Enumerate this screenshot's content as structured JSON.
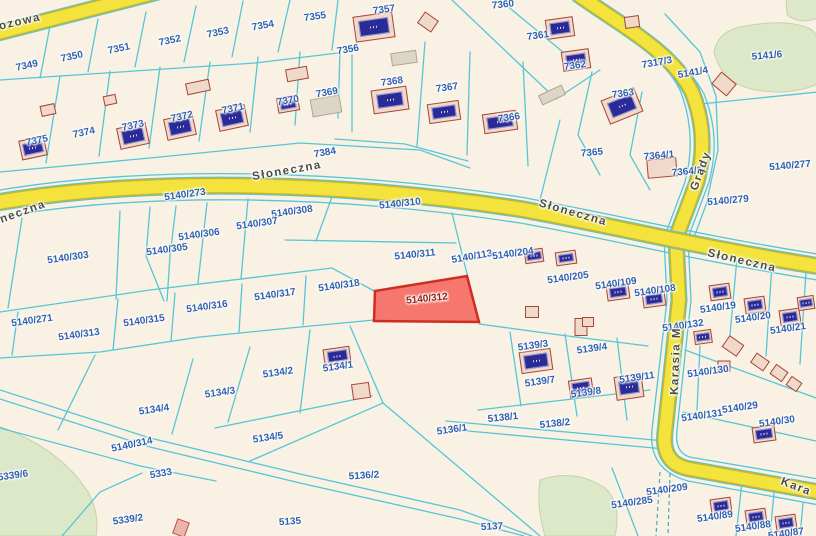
{
  "map": {
    "type": "cadastral-parcel-map",
    "highlighted_parcel": "5140/312",
    "colors": {
      "bg": "#f9f2e4",
      "boundary": "#55c6d6",
      "road": "#f3e33c",
      "roadedge": "#c9b62c",
      "casing": "#58c3d4",
      "green": "#dce8c8",
      "greenedge": "#c2d4a8",
      "bfill": "#f0d9c8",
      "bstroke": "#a6453a",
      "grayfill": "#dcd6c4",
      "pinkfill": "#e9b6ae",
      "chip": "#2b2b98",
      "label": "#2e5fae",
      "street": "#4c4c42",
      "hfill": "#f4695f",
      "hstroke": "#cf2d22",
      "hlabel": "#93221a"
    },
    "street_labels": [
      {
        "text": "ozowa",
        "x": 20,
        "y": 22,
        "r": -13
      },
      {
        "text": "neczna",
        "x": 23,
        "y": 212,
        "r": -20
      },
      {
        "text": "Słoneczna",
        "x": 287,
        "y": 171,
        "r": -10
      },
      {
        "text": "Słoneczna",
        "x": 573,
        "y": 213,
        "r": 16
      },
      {
        "text": "Słoneczna",
        "x": 742,
        "y": 261,
        "r": 13
      },
      {
        "text": "Grądy",
        "x": 701,
        "y": 171,
        "r": -70
      },
      {
        "text": "Karasia M",
        "x": 676,
        "y": 361,
        "r": -88
      },
      {
        "text": "Kara",
        "x": 796,
        "y": 487,
        "r": 21
      }
    ],
    "parcel_labels": [
      {
        "text": "7349",
        "x": 27,
        "y": 66,
        "r": -12
      },
      {
        "text": "7350",
        "x": 72,
        "y": 57,
        "r": -12
      },
      {
        "text": "7351",
        "x": 119,
        "y": 49,
        "r": -12
      },
      {
        "text": "7352",
        "x": 170,
        "y": 41,
        "r": -12
      },
      {
        "text": "7353",
        "x": 218,
        "y": 33,
        "r": -12
      },
      {
        "text": "7354",
        "x": 263,
        "y": 26,
        "r": -10
      },
      {
        "text": "7355",
        "x": 315,
        "y": 17,
        "r": -8
      },
      {
        "text": "7357",
        "x": 384,
        "y": 10,
        "r": -8
      },
      {
        "text": "7360",
        "x": 503,
        "y": 5,
        "r": -6
      },
      {
        "text": "7375",
        "x": 37,
        "y": 141,
        "r": -12
      },
      {
        "text": "7374",
        "x": 84,
        "y": 133,
        "r": -12
      },
      {
        "text": "7373",
        "x": 133,
        "y": 126,
        "r": -12
      },
      {
        "text": "7372",
        "x": 182,
        "y": 117,
        "r": -12
      },
      {
        "text": "7371",
        "x": 233,
        "y": 109,
        "r": -12
      },
      {
        "text": "7370",
        "x": 288,
        "y": 101,
        "r": -10
      },
      {
        "text": "7369",
        "x": 327,
        "y": 93,
        "r": -10
      },
      {
        "text": "7356",
        "x": 348,
        "y": 50,
        "r": -10
      },
      {
        "text": "7368",
        "x": 392,
        "y": 82,
        "r": -8
      },
      {
        "text": "7367",
        "x": 447,
        "y": 88,
        "r": -8
      },
      {
        "text": "7366",
        "x": 509,
        "y": 118,
        "r": -8
      },
      {
        "text": "7361",
        "x": 538,
        "y": 36,
        "r": -8
      },
      {
        "text": "7362",
        "x": 575,
        "y": 66,
        "r": -8
      },
      {
        "text": "7363",
        "x": 623,
        "y": 94,
        "r": -8
      },
      {
        "text": "7317/3",
        "x": 657,
        "y": 63,
        "r": -10
      },
      {
        "text": "5141/4",
        "x": 693,
        "y": 73,
        "r": -10
      },
      {
        "text": "5141/6",
        "x": 767,
        "y": 56,
        "r": -5
      },
      {
        "text": "7365",
        "x": 592,
        "y": 153,
        "r": -5
      },
      {
        "text": "7364/1",
        "x": 659,
        "y": 156,
        "r": -5
      },
      {
        "text": "7364/2",
        "x": 687,
        "y": 172,
        "r": -5
      },
      {
        "text": "5140/277",
        "x": 790,
        "y": 166,
        "r": -5
      },
      {
        "text": "7384",
        "x": 325,
        "y": 153,
        "r": -10
      },
      {
        "text": "5140/273",
        "x": 185,
        "y": 195,
        "r": -8
      },
      {
        "text": "5140/279",
        "x": 728,
        "y": 201,
        "r": -5
      },
      {
        "text": "5140/308",
        "x": 292,
        "y": 212,
        "r": -8
      },
      {
        "text": "5140/307",
        "x": 257,
        "y": 224,
        "r": -8
      },
      {
        "text": "5140/306",
        "x": 199,
        "y": 235,
        "r": -8
      },
      {
        "text": "5140/305",
        "x": 167,
        "y": 250,
        "r": -8
      },
      {
        "text": "5140/303",
        "x": 68,
        "y": 258,
        "r": -8
      },
      {
        "text": "5140/310",
        "x": 400,
        "y": 204,
        "r": -6
      },
      {
        "text": "5140/311",
        "x": 415,
        "y": 255,
        "r": -6
      },
      {
        "text": "5140/113",
        "x": 472,
        "y": 257,
        "r": -10
      },
      {
        "text": "5140/204",
        "x": 513,
        "y": 254,
        "r": -8
      },
      {
        "text": "5140/205",
        "x": 568,
        "y": 278,
        "r": -8
      },
      {
        "text": "5140/109",
        "x": 616,
        "y": 284,
        "r": -8
      },
      {
        "text": "5140/108",
        "x": 655,
        "y": 291,
        "r": -8
      },
      {
        "text": "5140/19",
        "x": 718,
        "y": 308,
        "r": -8
      },
      {
        "text": "5140/20",
        "x": 753,
        "y": 318,
        "r": -8
      },
      {
        "text": "5140/21",
        "x": 788,
        "y": 329,
        "r": -8
      },
      {
        "text": "5140/132",
        "x": 683,
        "y": 326,
        "r": -8
      },
      {
        "text": "5140/271",
        "x": 32,
        "y": 321,
        "r": -8
      },
      {
        "text": "5140/313",
        "x": 79,
        "y": 335,
        "r": -8
      },
      {
        "text": "5140/315",
        "x": 144,
        "y": 321,
        "r": -8
      },
      {
        "text": "5140/316",
        "x": 207,
        "y": 307,
        "r": -8
      },
      {
        "text": "5140/317",
        "x": 275,
        "y": 295,
        "r": -8
      },
      {
        "text": "5140/318",
        "x": 339,
        "y": 286,
        "r": -8
      },
      {
        "text": "5139/3",
        "x": 533,
        "y": 346,
        "r": -8
      },
      {
        "text": "5139/4",
        "x": 592,
        "y": 349,
        "r": -8
      },
      {
        "text": "5139/7",
        "x": 540,
        "y": 382,
        "r": -8
      },
      {
        "text": "5139/8",
        "x": 586,
        "y": 393,
        "r": -8
      },
      {
        "text": "5139/11",
        "x": 637,
        "y": 378,
        "r": -8
      },
      {
        "text": "5138/1",
        "x": 503,
        "y": 418,
        "r": -6
      },
      {
        "text": "5138/2",
        "x": 555,
        "y": 424,
        "r": -6
      },
      {
        "text": "5136/1",
        "x": 452,
        "y": 430,
        "r": -8
      },
      {
        "text": "5136/2",
        "x": 364,
        "y": 476,
        "r": -4
      },
      {
        "text": "5135",
        "x": 290,
        "y": 522,
        "r": -4
      },
      {
        "text": "5137",
        "x": 492,
        "y": 527,
        "r": -3
      },
      {
        "text": "5134/1",
        "x": 338,
        "y": 367,
        "r": -8
      },
      {
        "text": "5134/2",
        "x": 278,
        "y": 373,
        "r": -8
      },
      {
        "text": "5134/3",
        "x": 220,
        "y": 393,
        "r": -8
      },
      {
        "text": "5134/4",
        "x": 154,
        "y": 410,
        "r": -8
      },
      {
        "text": "5134/5",
        "x": 268,
        "y": 438,
        "r": -8
      },
      {
        "text": "5140/314",
        "x": 132,
        "y": 445,
        "r": -12
      },
      {
        "text": "5333",
        "x": 161,
        "y": 474,
        "r": -10
      },
      {
        "text": "5339/6",
        "x": 13,
        "y": 476,
        "r": -8
      },
      {
        "text": "5339/2",
        "x": 128,
        "y": 520,
        "r": -8
      },
      {
        "text": "5140/130",
        "x": 708,
        "y": 372,
        "r": -8
      },
      {
        "text": "5140/131",
        "x": 702,
        "y": 416,
        "r": -8
      },
      {
        "text": "5140/29",
        "x": 740,
        "y": 408,
        "r": -8
      },
      {
        "text": "5140/30",
        "x": 777,
        "y": 422,
        "r": -8
      },
      {
        "text": "5140/209",
        "x": 667,
        "y": 490,
        "r": -8
      },
      {
        "text": "5140/285",
        "x": 632,
        "y": 503,
        "r": -8
      },
      {
        "text": "5140/89",
        "x": 715,
        "y": 517,
        "r": -8
      },
      {
        "text": "5140/88",
        "x": 753,
        "y": 527,
        "r": -8
      },
      {
        "text": "5140/87",
        "x": 786,
        "y": 534,
        "r": -8
      },
      {
        "text": "5140/312",
        "x": 427,
        "y": 299,
        "r": -6,
        "variant": "h"
      }
    ],
    "buildings": [
      {
        "x": 33,
        "y": 148,
        "w": 26,
        "h": 20,
        "r": -12,
        "s": "chip"
      },
      {
        "x": 133,
        "y": 136,
        "w": 30,
        "h": 22,
        "r": -12,
        "s": "chip"
      },
      {
        "x": 180,
        "y": 127,
        "w": 30,
        "h": 22,
        "r": -12,
        "s": "chip"
      },
      {
        "x": 232,
        "y": 118,
        "w": 30,
        "h": 22,
        "r": -12,
        "s": "chip"
      },
      {
        "x": 48,
        "y": 110,
        "w": 15,
        "h": 11,
        "r": -12,
        "s": "plain"
      },
      {
        "x": 110,
        "y": 100,
        "w": 13,
        "h": 10,
        "r": -12,
        "s": "plain"
      },
      {
        "x": 198,
        "y": 87,
        "w": 24,
        "h": 12,
        "r": -12,
        "s": "plain"
      },
      {
        "x": 288,
        "y": 104,
        "w": 22,
        "h": 16,
        "r": -10,
        "s": "chip"
      },
      {
        "x": 326,
        "y": 106,
        "w": 30,
        "h": 18,
        "r": -10,
        "s": "gray"
      },
      {
        "x": 374,
        "y": 27,
        "w": 40,
        "h": 26,
        "r": -8,
        "s": "chip"
      },
      {
        "x": 428,
        "y": 22,
        "w": 17,
        "h": 14,
        "r": 35,
        "s": "plain"
      },
      {
        "x": 297,
        "y": 74,
        "w": 22,
        "h": 13,
        "r": -10,
        "s": "plain"
      },
      {
        "x": 404,
        "y": 58,
        "w": 26,
        "h": 13,
        "r": -8,
        "s": "gray"
      },
      {
        "x": 390,
        "y": 100,
        "w": 36,
        "h": 24,
        "r": -8,
        "s": "chip"
      },
      {
        "x": 444,
        "y": 112,
        "w": 32,
        "h": 20,
        "r": -8,
        "s": "chip"
      },
      {
        "x": 500,
        "y": 122,
        "w": 34,
        "h": 20,
        "r": -8,
        "s": "chip"
      },
      {
        "x": 560,
        "y": 28,
        "w": 28,
        "h": 20,
        "r": -8,
        "s": "chip"
      },
      {
        "x": 576,
        "y": 60,
        "w": 28,
        "h": 20,
        "r": -8,
        "s": "chip"
      },
      {
        "x": 622,
        "y": 106,
        "w": 36,
        "h": 26,
        "r": -22,
        "s": "chip"
      },
      {
        "x": 632,
        "y": 22,
        "w": 15,
        "h": 12,
        "r": -8,
        "s": "plain"
      },
      {
        "x": 552,
        "y": 95,
        "w": 26,
        "h": 11,
        "r": -25,
        "s": "gray"
      },
      {
        "x": 724,
        "y": 84,
        "w": 20,
        "h": 16,
        "r": 40,
        "s": "plain"
      },
      {
        "x": 662,
        "y": 168,
        "w": 30,
        "h": 19,
        "r": -5,
        "s": "plain"
      },
      {
        "x": 534,
        "y": 256,
        "w": 19,
        "h": 14,
        "r": -8,
        "s": "chip"
      },
      {
        "x": 566,
        "y": 258,
        "w": 21,
        "h": 14,
        "r": -8,
        "s": "chip"
      },
      {
        "x": 618,
        "y": 292,
        "w": 23,
        "h": 16,
        "r": -8,
        "s": "chip"
      },
      {
        "x": 654,
        "y": 299,
        "w": 23,
        "h": 16,
        "r": -8,
        "s": "chip"
      },
      {
        "x": 720,
        "y": 292,
        "w": 21,
        "h": 16,
        "r": -8,
        "s": "chip"
      },
      {
        "x": 755,
        "y": 305,
        "w": 21,
        "h": 16,
        "r": -8,
        "s": "chip"
      },
      {
        "x": 790,
        "y": 317,
        "w": 21,
        "h": 16,
        "r": -8,
        "s": "chip"
      },
      {
        "x": 806,
        "y": 303,
        "w": 17,
        "h": 14,
        "r": -8,
        "s": "chip"
      },
      {
        "x": 703,
        "y": 337,
        "w": 18,
        "h": 14,
        "r": -8,
        "s": "chip"
      },
      {
        "x": 536,
        "y": 361,
        "w": 32,
        "h": 22,
        "r": -8,
        "s": "chip"
      },
      {
        "x": 581,
        "y": 388,
        "w": 24,
        "h": 18,
        "r": -8,
        "s": "chip"
      },
      {
        "x": 629,
        "y": 387,
        "w": 28,
        "h": 24,
        "r": -8,
        "s": "chip"
      },
      {
        "x": 337,
        "y": 356,
        "w": 27,
        "h": 17,
        "r": -8,
        "s": "chip"
      },
      {
        "x": 361,
        "y": 391,
        "w": 18,
        "h": 16,
        "r": -8,
        "s": "plain"
      },
      {
        "x": 764,
        "y": 434,
        "w": 23,
        "h": 16,
        "r": -8,
        "s": "chip"
      },
      {
        "x": 721,
        "y": 506,
        "w": 21,
        "h": 16,
        "r": -8,
        "s": "chip"
      },
      {
        "x": 756,
        "y": 517,
        "w": 21,
        "h": 16,
        "r": -8,
        "s": "chip"
      },
      {
        "x": 786,
        "y": 523,
        "w": 21,
        "h": 16,
        "r": -8,
        "s": "chip"
      },
      {
        "x": 181,
        "y": 528,
        "w": 13,
        "h": 16,
        "r": 20,
        "s": "pink"
      },
      {
        "x": 733,
        "y": 346,
        "w": 18,
        "h": 14,
        "r": 35,
        "s": "plain"
      },
      {
        "x": 760,
        "y": 362,
        "w": 16,
        "h": 12,
        "r": 35,
        "s": "plain"
      },
      {
        "x": 779,
        "y": 373,
        "w": 15,
        "h": 12,
        "r": 35,
        "s": "plain"
      },
      {
        "x": 794,
        "y": 384,
        "w": 13,
        "h": 11,
        "r": 35,
        "s": "plain"
      },
      {
        "x": 724,
        "y": 366,
        "w": 13,
        "h": 11,
        "r": 0,
        "s": "plain"
      },
      {
        "x": 581,
        "y": 327,
        "w": 13,
        "h": 18,
        "r": 0,
        "s": "plain"
      },
      {
        "x": 532,
        "y": 312,
        "w": 14,
        "h": 12,
        "r": 0,
        "s": "plain"
      },
      {
        "x": 588,
        "y": 322,
        "w": 12,
        "h": 10,
        "r": 0,
        "s": "plain"
      }
    ]
  }
}
